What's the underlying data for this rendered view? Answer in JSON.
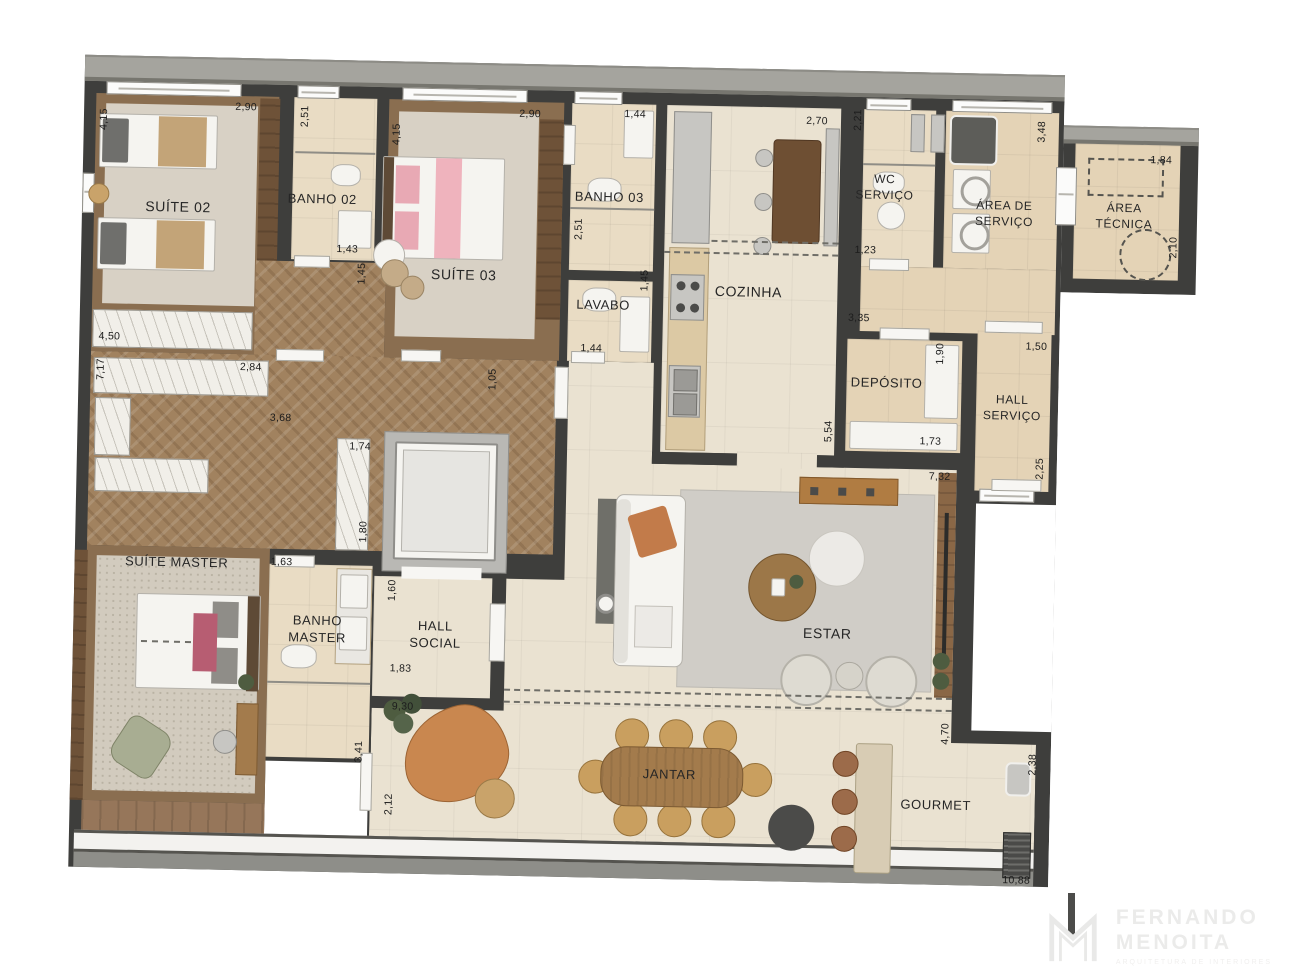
{
  "plan": {
    "rooms": [
      {
        "id": "suite02",
        "label": "SUÍTE 02",
        "x": 96,
        "y": 150,
        "fs": 14
      },
      {
        "id": "banho02",
        "label": "BANHO 02",
        "x": 240,
        "y": 140,
        "fs": 13
      },
      {
        "id": "suite03",
        "label": "SUÍTE 03",
        "x": 383,
        "y": 212,
        "fs": 14
      },
      {
        "id": "banho03",
        "label": "BANHO 03",
        "x": 527,
        "y": 132,
        "fs": 13
      },
      {
        "id": "lavabo",
        "label": "LAVABO",
        "x": 523,
        "y": 240,
        "fs": 13
      },
      {
        "id": "cozinha",
        "label": "COZINHA",
        "x": 668,
        "y": 223,
        "fs": 14
      },
      {
        "id": "wc-servico",
        "label": "WC\nSERVIÇO",
        "x": 802,
        "y": 116,
        "fs": 12
      },
      {
        "id": "area-servico",
        "label": "ÁREA DE\nSERVIÇO",
        "x": 922,
        "y": 140,
        "fs": 12
      },
      {
        "id": "area-tecnica",
        "label": "ÁREA\nTÉCNICA",
        "x": 1042,
        "y": 140,
        "fs": 12
      },
      {
        "id": "deposito",
        "label": "DEPÓSITO",
        "x": 808,
        "y": 312,
        "fs": 13
      },
      {
        "id": "hall-servico",
        "label": "HALL\nSERVIÇO",
        "x": 934,
        "y": 334,
        "fs": 12
      },
      {
        "id": "suite-master",
        "label": "SUÍTE MASTER",
        "x": 102,
        "y": 506,
        "fs": 13
      },
      {
        "id": "banho-master",
        "label": "BANHO\nMASTER",
        "x": 244,
        "y": 570,
        "fs": 13
      },
      {
        "id": "hall-social",
        "label": "HALL\nSOCIAL",
        "x": 362,
        "y": 573,
        "fs": 13
      },
      {
        "id": "estar",
        "label": "ESTAR",
        "x": 754,
        "y": 563,
        "fs": 14
      },
      {
        "id": "jantar",
        "label": "JANTAR",
        "x": 599,
        "y": 708,
        "fs": 13
      },
      {
        "id": "gourmet",
        "label": "GOURMET",
        "x": 866,
        "y": 733,
        "fs": 13
      }
    ],
    "dims": [
      {
        "v": "4,15",
        "x": 20,
        "y": 64,
        "r": -90
      },
      {
        "v": "2,90",
        "x": 162,
        "y": 49,
        "r": 0
      },
      {
        "v": "2,51",
        "x": 221,
        "y": 57,
        "r": -90
      },
      {
        "v": "1,43",
        "x": 266,
        "y": 189,
        "r": 0
      },
      {
        "v": "1,45",
        "x": 281,
        "y": 213,
        "r": -90
      },
      {
        "v": "4,15",
        "x": 313,
        "y": 73,
        "r": -90
      },
      {
        "v": "2,90",
        "x": 446,
        "y": 50,
        "r": 0
      },
      {
        "v": "1,44",
        "x": 551,
        "y": 48,
        "r": 0
      },
      {
        "v": "2,51",
        "x": 497,
        "y": 164,
        "r": -90
      },
      {
        "v": "1,45",
        "x": 564,
        "y": 214,
        "r": -90
      },
      {
        "v": "1,44",
        "x": 512,
        "y": 283,
        "r": 0
      },
      {
        "v": "2,70",
        "x": 733,
        "y": 51,
        "r": 0
      },
      {
        "v": "2,21",
        "x": 774,
        "y": 49,
        "r": -90
      },
      {
        "v": "1,23",
        "x": 784,
        "y": 179,
        "r": 0
      },
      {
        "v": "3,48",
        "x": 958,
        "y": 57,
        "r": -90
      },
      {
        "v": "1,84",
        "x": 1078,
        "y": 83,
        "r": 0
      },
      {
        "v": "2,10",
        "x": 1092,
        "y": 170,
        "r": -90
      },
      {
        "v": "4,50",
        "x": 30,
        "y": 281,
        "r": 0
      },
      {
        "v": "7,17",
        "x": 22,
        "y": 314,
        "r": -90
      },
      {
        "v": "2,84",
        "x": 172,
        "y": 309,
        "r": 0
      },
      {
        "v": "3,68",
        "x": 203,
        "y": 359,
        "r": 0
      },
      {
        "v": "1,05",
        "x": 414,
        "y": 316,
        "r": -90
      },
      {
        "v": "1,74",
        "x": 283,
        "y": 386,
        "r": 0
      },
      {
        "v": "1,80",
        "x": 288,
        "y": 471,
        "r": -90
      },
      {
        "v": "1,60",
        "x": 318,
        "y": 529,
        "r": -90
      },
      {
        "v": "1,83",
        "x": 328,
        "y": 607,
        "r": 0
      },
      {
        "v": "1,63",
        "x": 207,
        "y": 503,
        "r": 0
      },
      {
        "v": "3,41",
        "x": 288,
        "y": 691,
        "r": -90
      },
      {
        "v": "9,30",
        "x": 331,
        "y": 645,
        "r": 0
      },
      {
        "v": "2,12",
        "x": 319,
        "y": 743,
        "r": -90
      },
      {
        "v": "3,35",
        "x": 779,
        "y": 247,
        "r": 0
      },
      {
        "v": "5,54",
        "x": 751,
        "y": 361,
        "r": -90
      },
      {
        "v": "1,90",
        "x": 861,
        "y": 281,
        "r": -90
      },
      {
        "v": "1,73",
        "x": 853,
        "y": 369,
        "r": 0
      },
      {
        "v": "1,50",
        "x": 957,
        "y": 272,
        "r": 0
      },
      {
        "v": "2,25",
        "x": 963,
        "y": 394,
        "r": -90
      },
      {
        "v": "7,32",
        "x": 863,
        "y": 404,
        "r": 0
      },
      {
        "v": "4,70",
        "x": 874,
        "y": 661,
        "r": -90
      },
      {
        "v": "2,38",
        "x": 962,
        "y": 690,
        "r": -90
      },
      {
        "v": "10,88",
        "x": 948,
        "y": 806,
        "r": 0
      }
    ]
  },
  "watermark": {
    "line1": "FERNANDO",
    "line2": "MENOITA",
    "tagline": "ARQUITETURA DE INTERIORES"
  }
}
